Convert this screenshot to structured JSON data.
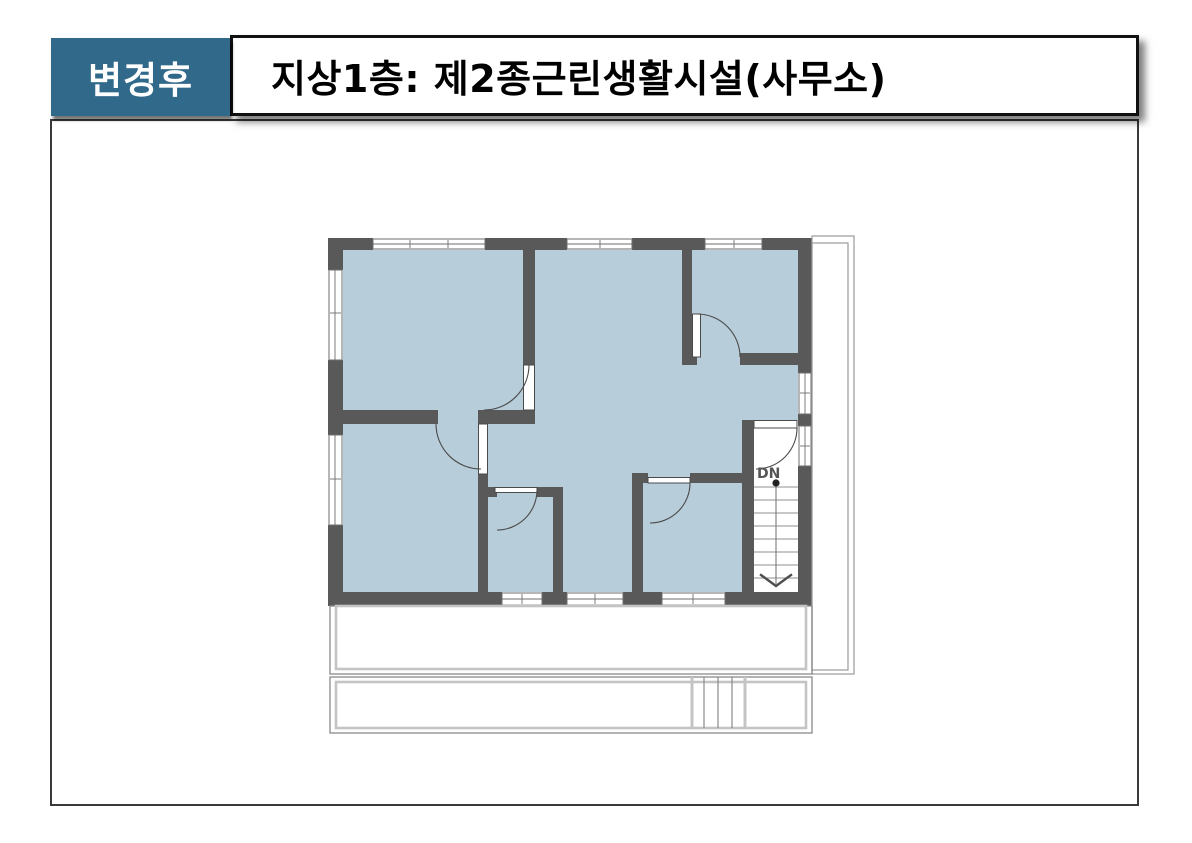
{
  "header": {
    "change_label": "변경후",
    "title": "지상1층: 제2종근린생활시설(사무소)"
  },
  "floor_plan": {
    "stairs_label": "DN"
  },
  "colors": {
    "accent": "#30698a",
    "wall": "#595959",
    "floor": "#b7cdd9",
    "line": "#555555"
  }
}
